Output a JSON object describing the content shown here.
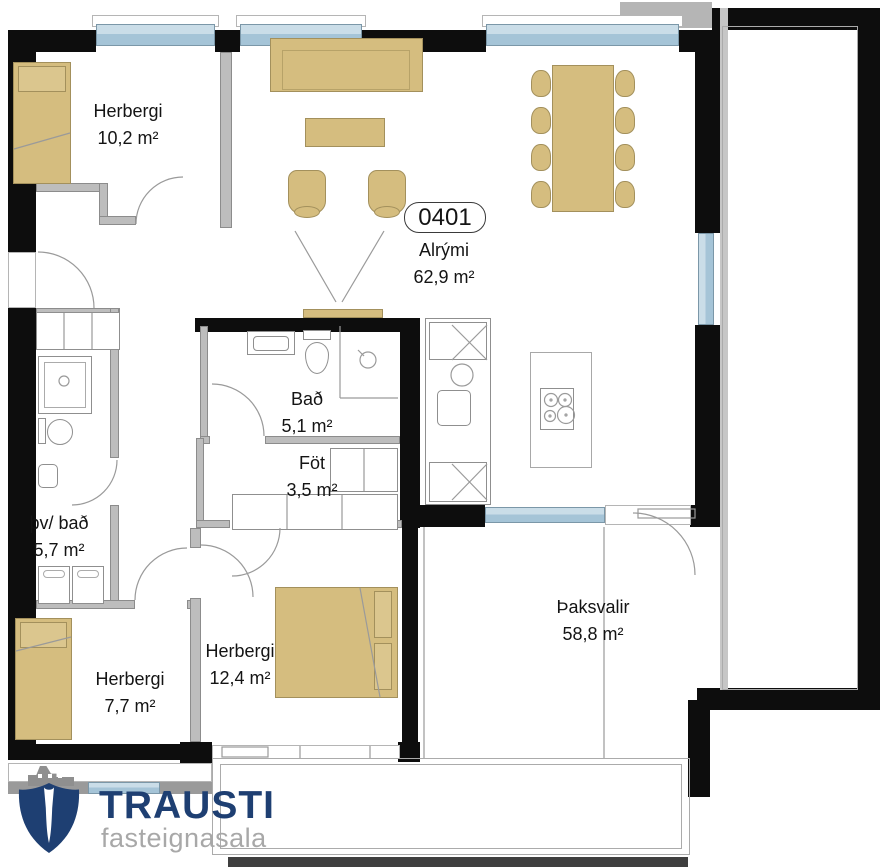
{
  "unit": {
    "number": "0401"
  },
  "rooms": [
    {
      "id": "herbergi-102",
      "name": "Herbergi",
      "area": "10,2 m²"
    },
    {
      "id": "alrymi",
      "name": "Alrými",
      "area": "62,9 m²"
    },
    {
      "id": "bad",
      "name": "Bað",
      "area": "5,1 m²"
    },
    {
      "id": "fot",
      "name": "Föt",
      "area": "3,5 m²"
    },
    {
      "id": "tv-bad",
      "name": "þv/ bað",
      "area": "5,7 m²"
    },
    {
      "id": "herbergi-77",
      "name": "Herbergi",
      "area": "7,7 m²"
    },
    {
      "id": "herbergi-124",
      "name": "Herbergi",
      "area": "12,4 m²"
    },
    {
      "id": "thaksvalir",
      "name": "Þaksvalir",
      "area": "58,8 m²"
    }
  ],
  "branding": {
    "name": "TRAUSTI",
    "tagline": "fasteignasala"
  },
  "colors": {
    "wall": "#0d0d0d",
    "partition": "#bdbdbd",
    "furniture": "#d5bd7f",
    "window": "#a5c4d7",
    "logo_navy": "#1e3f72",
    "logo_gray": "#a8a8a8"
  }
}
